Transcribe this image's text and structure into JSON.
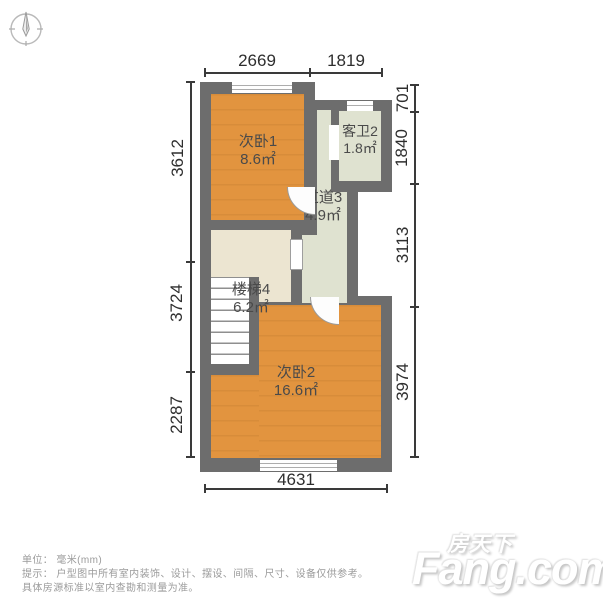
{
  "rooms": [
    {
      "name": "次卧1",
      "area": "8.6㎡"
    },
    {
      "name": "客卫2",
      "area": "1.8㎡"
    },
    {
      "name": "过道3",
      "area": "4.9㎡"
    },
    {
      "name": "楼梯4",
      "area": "6.2㎡"
    },
    {
      "name": "次卧2",
      "area": "16.6㎡"
    }
  ],
  "dims": {
    "top": [
      "2669",
      "1819"
    ],
    "right": [
      "701",
      "1840",
      "3113",
      "3974"
    ],
    "left": [
      "3612",
      "3724",
      "2287"
    ],
    "bottom": [
      "4631"
    ]
  },
  "footer": {
    "line1": "单位： 毫米(mm)",
    "line2": "提示： 户型图中所有室内装饰、设计、摆设、间隔、尺寸、设备仅供参考。",
    "line3": "具体房源标准以室内查勘和测量为准。"
  },
  "watermark": {
    "cn": "房天下",
    "en": "Fang.com"
  },
  "icons": {
    "compass": "compass-icon"
  },
  "colors": {
    "wall": "#6d6d6d",
    "bedroom_floor": "#e2943f",
    "bath_hall_floor": "#dfe2d0",
    "stairs_floor": "#ece5d1",
    "dimension_text": "#2e2e2e",
    "footer_text": "#9b9b9b"
  },
  "unit": "mm"
}
